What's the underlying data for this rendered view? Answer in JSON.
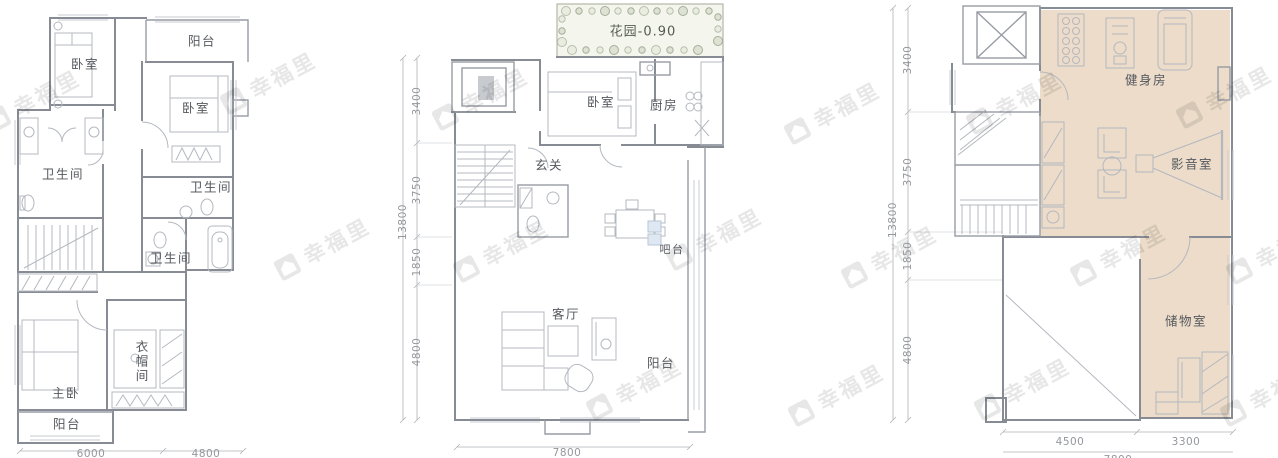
{
  "watermark": {
    "brand": "幸福里"
  },
  "left": {
    "rooms": {
      "bedroom1": "卧室",
      "balcony_top": "阳台",
      "bedroom2": "卧室",
      "bath1": "卫生间",
      "bath2": "卫生间",
      "bath3": "卫生间",
      "master": "主卧",
      "cloakroom": "衣帽间",
      "balcony_bottom": "阳台"
    },
    "dims": {
      "width1": "6000",
      "width2": "4800"
    }
  },
  "middle": {
    "garden": "花园-0.90",
    "rooms": {
      "bedroom": "卧室",
      "kitchen": "厨房",
      "foyer": "玄关",
      "bar": "吧台",
      "living": "客厅",
      "balcony": "阳台"
    },
    "dims": {
      "total_height": "13800",
      "h1": "3400",
      "h2": "3750",
      "h3": "1850",
      "h4": "4800",
      "width": "7800"
    }
  },
  "right": {
    "rooms": {
      "gym": "健身房",
      "media": "影音室",
      "storage": "储物室"
    },
    "dims": {
      "total_height": "13800",
      "h1": "3400",
      "h2": "3750",
      "h3": "1850",
      "h4": "4800",
      "w1": "4500",
      "w2": "3300",
      "total_width": "7800"
    }
  }
}
